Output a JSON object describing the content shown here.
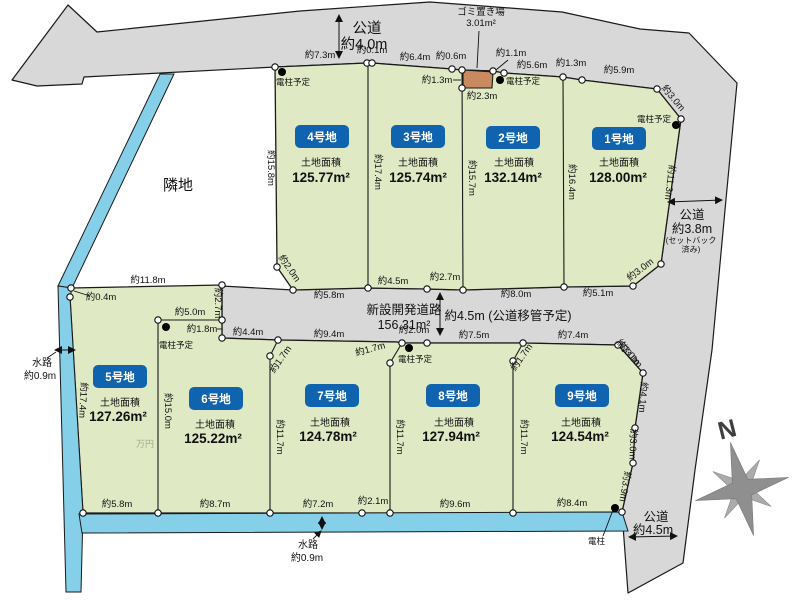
{
  "diagram": {
    "neighbor_label": "隣地",
    "watermark": "万円",
    "compass_label": "N"
  },
  "roads": {
    "top_name": "公道",
    "top_width": "約4.0m",
    "right_name": "公道",
    "right_width": "約3.8m",
    "right_note1": "(セットバック",
    "right_note2": "済み)",
    "center_name": "新設開発道路",
    "center_area": "156.31m²",
    "center_width": "約4.5m (公道移管予定)",
    "bottom_name": "公道",
    "bottom_width": "約4.5m"
  },
  "waterway": {
    "left_name": "水路",
    "left_width": "約0.9m",
    "bottom_name": "水路",
    "bottom_width": "約0.9m"
  },
  "garbage": {
    "name": "ゴミ置き場",
    "area": "3.01m²",
    "dim_left": "約1.3m",
    "dim_bottom": "約2.3m"
  },
  "poles": {
    "planned": "電柱予定",
    "existing": "電柱"
  },
  "plots": [
    {
      "id": "1号地",
      "area_label": "土地面積",
      "area": "128.00m²"
    },
    {
      "id": "2号地",
      "area_label": "土地面積",
      "area": "132.14m²"
    },
    {
      "id": "3号地",
      "area_label": "土地面積",
      "area": "125.74m²"
    },
    {
      "id": "4号地",
      "area_label": "土地面積",
      "area": "125.77m²"
    },
    {
      "id": "5号地",
      "area_label": "土地面積",
      "area": "127.26m²"
    },
    {
      "id": "6号地",
      "area_label": "土地面積",
      "area": "125.22m²"
    },
    {
      "id": "7号地",
      "area_label": "土地面積",
      "area": "124.78m²"
    },
    {
      "id": "8号地",
      "area_label": "土地面積",
      "area": "127.94m²"
    },
    {
      "id": "9号地",
      "area_label": "土地面積",
      "area": "124.54m²"
    }
  ],
  "dims": {
    "top_edge": [
      "約7.3m",
      "約0.1m",
      "約6.4m",
      "約0.6m",
      "約1.1m",
      "約5.6m",
      "約1.3m",
      "約5.9m",
      "約3.0m"
    ],
    "top_row_sides": [
      "約15.8m",
      "約17.4m",
      "約15.7m",
      "約16.4m",
      "約11.3m",
      "約3.0m"
    ],
    "top_row_bottom": [
      "約2.0m",
      "約5.8m",
      "約4.5m",
      "約2.7m",
      "約8.0m",
      "約5.1m"
    ],
    "road_south": [
      "約4.4m",
      "約9.4m",
      "約2.0m",
      "約7.5m",
      "約7.4m",
      "約3.0m"
    ],
    "jogs": [
      "約1.7m",
      "約1.7m",
      "約1.7m"
    ],
    "plot5_edges": [
      "約11.8m",
      "約0.4m",
      "約2.7m",
      "約5.0m",
      "約1.8m"
    ],
    "bottom_row_sides": [
      "約17.4m",
      "約15.0m",
      "約11.7m",
      "約11.7m",
      "約11.7m"
    ],
    "plot9_east": [
      "約3.0m",
      "約4.1m",
      "約3.0m",
      "約3.9m"
    ],
    "bottom_edge": [
      "約5.8m",
      "約8.7m",
      "約7.2m",
      "約2.1m",
      "約9.6m",
      "約8.4m"
    ]
  },
  "colors": {
    "road": "#d8d8d8",
    "plot_green": "#dfe9c4",
    "water_blue": "#85cfe9",
    "badge_blue": "#1063ae",
    "garbage_tan": "#c98a5f"
  }
}
